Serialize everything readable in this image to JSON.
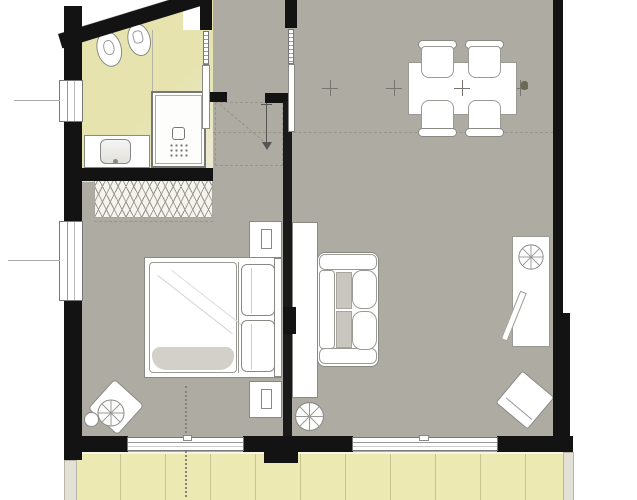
{
  "meta": {
    "title": "Apartment floor plan",
    "drawing_type": "architectural floor plan, top view",
    "visible_text": []
  },
  "colors": {
    "outside": "#ffffff",
    "floor": "#aeaba2",
    "wall": "#131313",
    "outline": "#8a8a85",
    "bath1": "#e6e3ae",
    "bath2": "#edead8",
    "balcony": "#ece9b3",
    "balconyline": "#c9c592",
    "cushion": "#c9c6bf",
    "dash": "#98948b",
    "blanket": "#d3d0c9",
    "edge": "#e3e1d6"
  },
  "rooms": {
    "bathroom": "Bathroom",
    "hall": "Entry hall",
    "bedroom": "Bedroom",
    "living": "Living and dining room",
    "balcony": "Balcony"
  },
  "furniture": {
    "bathroom": [
      "toilet",
      "bidet",
      "shower",
      "vanity-sink"
    ],
    "bedroom": [
      "wardrobe",
      "double-bed",
      "nightstand",
      "nightstand",
      "armchair",
      "fan-side-table"
    ],
    "living": [
      "sofa",
      "sideboard",
      "round-table",
      "desk",
      "desk-chair",
      "floor-lamp",
      "armchair",
      "dining-table",
      "dining-chair x4"
    ],
    "markers": [
      "entry-arrow",
      "door-swing-dashes",
      "axis-crosses",
      "section-dotted-line"
    ]
  }
}
